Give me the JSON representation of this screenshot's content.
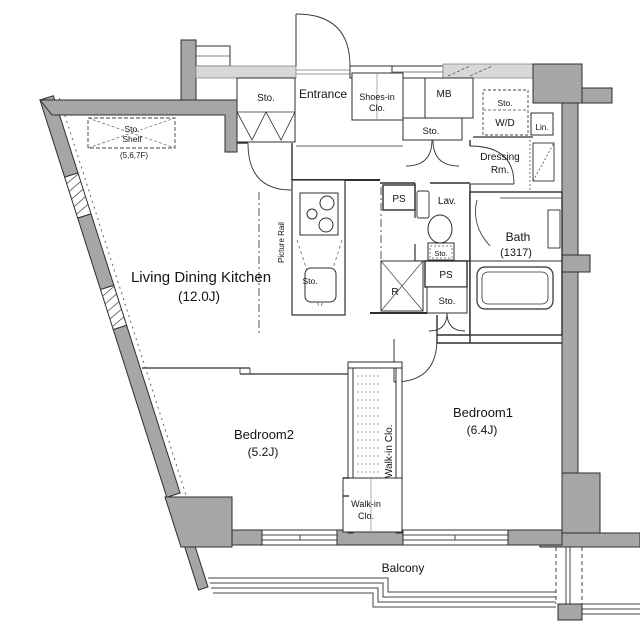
{
  "plan": {
    "title": "apartment-floor-plan",
    "colors": {
      "wall_gray": "#a6a6a6",
      "wall_light_gray": "#d8d8d8",
      "line": "#2e2e2e",
      "background": "#ffffff"
    },
    "labels": {
      "sto_entrance": "Sto.",
      "entrance": "Entrance",
      "shoes_line1": "Shoes-in",
      "shoes_line2": "Clo.",
      "mb": "MB",
      "sto_hall": "Sto.",
      "sto_wd": "Sto.",
      "wd": "W/D",
      "lin": "Lin.",
      "dressing_line1": "Dressing",
      "dressing_line2": "Rm.",
      "sto_shelf_line1": "Sto.",
      "sto_shelf_line2": "Shelf",
      "sto_shelf_floors": "(5,6,7F)",
      "ps_upper": "PS",
      "lav": "Lav.",
      "sto_toilet": "Sto.",
      "bath_line1": "Bath",
      "bath_line2": "(1317)",
      "ldk_line1": "Living Dining Kitchen",
      "ldk_line2": "(12.0J)",
      "picture_rail": "Picture Rail",
      "sto_kitchen": "Sto.",
      "fridge": "R",
      "ps_lower": "PS",
      "sto_corridor": "Sto.",
      "bedroom2_line1": "Bedroom2",
      "bedroom2_line2": "(5.2J)",
      "walkin_vertical": "Walk-in Clo.",
      "walkin_line1": "Walk-in",
      "walkin_line2": "Clo.",
      "bedroom1_line1": "Bedroom1",
      "bedroom1_line2": "(6.4J)",
      "balcony": "Balcony"
    }
  }
}
